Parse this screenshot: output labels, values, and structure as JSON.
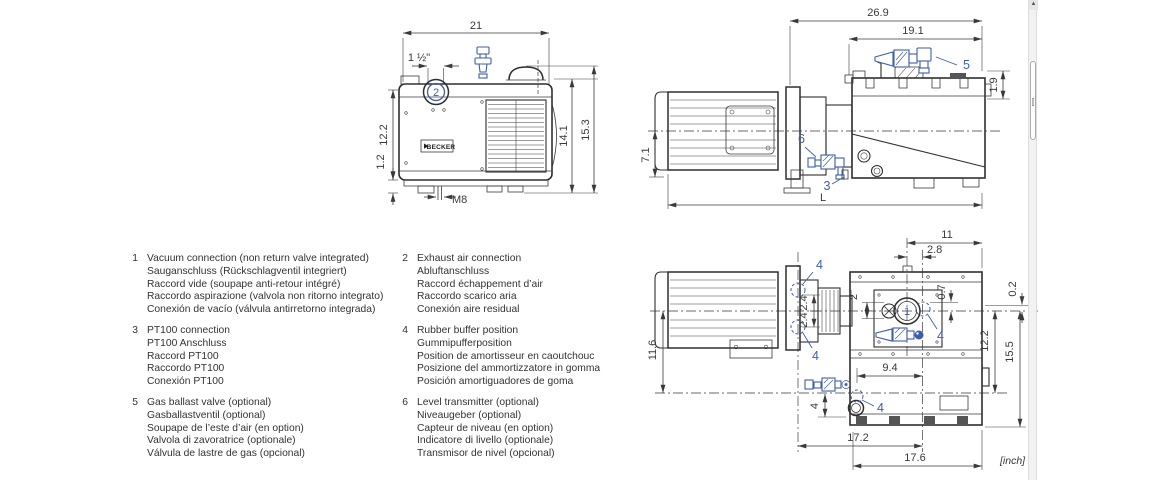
{
  "page": {
    "unit_note": "[inch]",
    "brand": "BECKER"
  },
  "colors": {
    "line": "#3a3a3a",
    "accent_blue": "#3f5ea9"
  },
  "views": {
    "front": {
      "dims": {
        "overall_width": "21",
        "exhaust_size": "1 ½\"",
        "body_height": "12.2",
        "foot_height": "1.2",
        "tank_height": "14.1",
        "overall_height": "15.3",
        "thread": "M8"
      },
      "balloons": {
        "exhaust": "2"
      }
    },
    "side": {
      "dims": {
        "overall_depth": "26.9",
        "tank_depth": "19.1",
        "top_offset": "1.9",
        "axis_height": "7.1",
        "length": "L"
      },
      "balloons": {
        "gas_ballast": "5",
        "level_transmitter": "6",
        "pt100": "3"
      }
    },
    "top": {
      "dims": {
        "port_to_edge": "11",
        "port_offset": "2.8",
        "port_size": "2\"",
        "buffer_offset": "0.7",
        "edge_offset": "0.2",
        "flange_upper": "2.4",
        "flange_lower": "2.4",
        "axis_to_line": "11.6",
        "tank_width": "12.2",
        "tank_overall": "15.5",
        "buffer_span": "9.4",
        "drain_offset": "4",
        "flange_to_buffer": "17.2",
        "tank_length": "17.6"
      },
      "balloons": {
        "vacuum": "1",
        "buffer": "4"
      }
    }
  },
  "legend": {
    "items": [
      {
        "num": "1",
        "lines": [
          "Vacuum connection (non return valve integrated)",
          "Sauganschluss (Rückschlagventil integriert)",
          "Raccord vide (soupape anti-retour intégré)",
          "Raccordo aspirazione (valvola non ritorno integrato)",
          "Conexión de vacío (válvula antirretorno integrada)"
        ]
      },
      {
        "num": "2",
        "lines": [
          "Exhaust air connection",
          "Abluftanschluss",
          "Raccord échappement d’air",
          "Raccordo scarico aria",
          "Conexión aire residual"
        ]
      },
      {
        "num": "3",
        "lines": [
          "PT100 connection",
          "PT100 Anschluss",
          "Raccord PT100",
          "Raccordo PT100",
          "Conexión PT100"
        ]
      },
      {
        "num": "4",
        "lines": [
          "Rubber buffer position",
          "Gummipufferposition",
          "Position de amortisseur en caoutchouc",
          "Posizione del ammortizzatore in gomma",
          "Posición amortiguadores de goma"
        ]
      },
      {
        "num": "5",
        "lines": [
          "Gas ballast valve (optional)",
          "Gasballastventil (optional)",
          "Soupape de l’este d’air (en option)",
          "Valvola di zavoratrice (optionale)",
          "Válvula de lastre de gas (opcional)"
        ]
      },
      {
        "num": "6",
        "lines": [
          "Level transmitter (optional)",
          "Niveaugeber (optional)",
          "Capteur de niveau (en option)",
          "Indicatore di livello (optionale)",
          "Transmisor de nivel (opcional)"
        ]
      }
    ]
  }
}
